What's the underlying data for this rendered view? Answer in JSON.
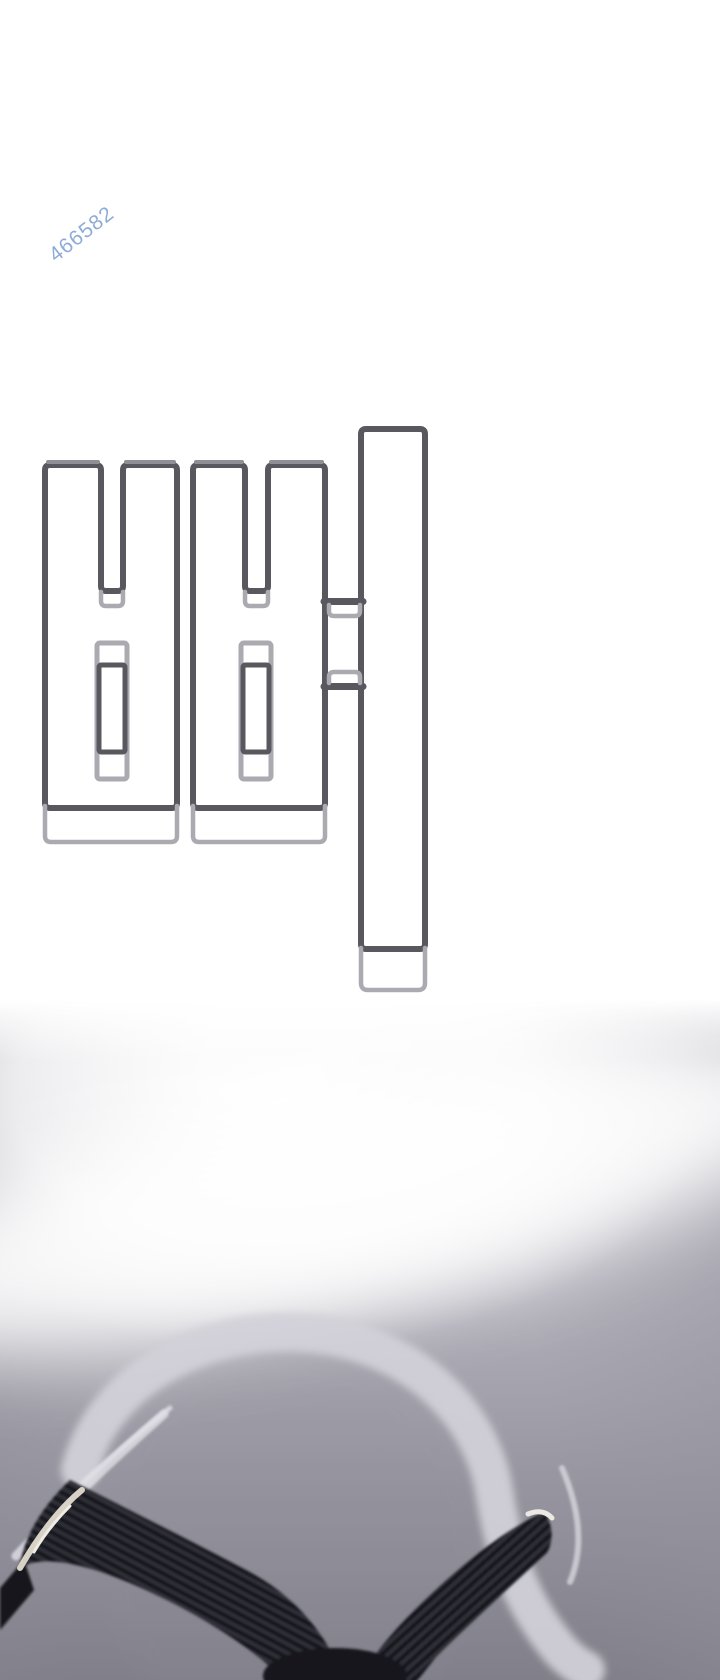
{
  "page": {
    "width": 720,
    "height": 1680,
    "background": "#ffffff"
  },
  "watermark": {
    "text": "466582",
    "color": "#7b9dd2",
    "rotation_deg": -38
  },
  "sound_effect": {
    "character": "뻐",
    "style": "outlined bubble lettering",
    "stroke_dark": "#58585e",
    "stroke_light": "#aaaab0",
    "cap_highlight": "#8f8f95"
  },
  "artwork": {
    "description": "motion-blurred legs in black pants mid-spin-kick forming a V, with a large circular swoosh arc",
    "swoosh_color": "#d3d1d9",
    "leg_color": "#16161b",
    "rib_color": "#32323b",
    "shoe_sole_color": "#d8d2c6",
    "shoe_glint_color": "#ece9e3",
    "background_top": "#ffffff",
    "background_mid": "#a9a7b1",
    "background_bottom": "#817f89"
  }
}
